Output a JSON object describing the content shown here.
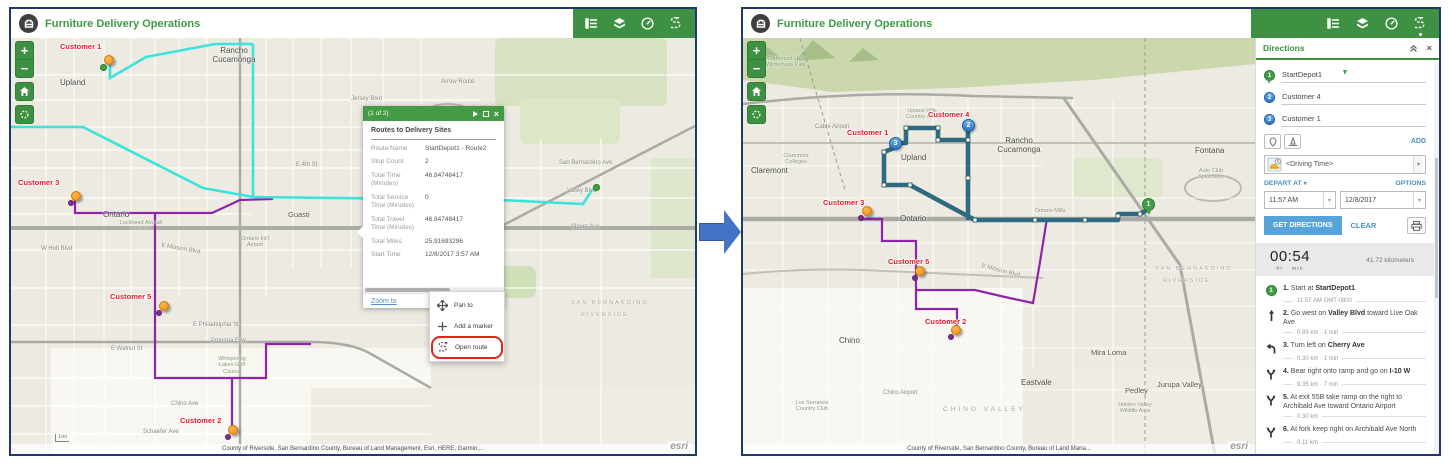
{
  "app": {
    "title": "Furniture Delivery Operations"
  },
  "colors": {
    "header_green": "#3E9142",
    "popup_green": "#459B45",
    "link_blue": "#4A90C4",
    "button_blue": "#58A3D9",
    "customer_red": "#E01726",
    "route_cyan": "#3BE3DB",
    "route_purple": "#8E24AA",
    "route_teal": "#2F6B80",
    "marker_orange": "#F5921E",
    "arrow_blue": "#4472C4"
  },
  "left": {
    "customers": [
      "Customer 1",
      "Customer 3",
      "Customer 5",
      "Customer 2"
    ],
    "popup": {
      "pager": "(1 of 2)",
      "title": "Routes to Delivery Sites",
      "fields": [
        {
          "label": "Route Name",
          "value": "StartDepot1 - Route2"
        },
        {
          "label": "Stop Count",
          "value": "2"
        },
        {
          "label": "Total Time (Minutes)",
          "value": "46.84748417"
        },
        {
          "label": "Total Service Time (Minutes)",
          "value": "0"
        },
        {
          "label": "Total Travel Time (Minutes)",
          "value": "46.84748417"
        },
        {
          "label": "Total Miles",
          "value": "25.91693296"
        },
        {
          "label": "Start Time",
          "value": "12/8/2017 3:57 AM"
        }
      ],
      "zoom_to": "Zoom to",
      "more": "..."
    },
    "menu": {
      "items": [
        {
          "label": "Pan to"
        },
        {
          "label": "Add a marker"
        },
        {
          "label": "Open route"
        }
      ]
    },
    "map_labels": [
      {
        "t": "Upland"
      },
      {
        "t": "Rancho Cucamonga"
      },
      {
        "t": "Ontario"
      },
      {
        "t": "Guasti"
      },
      {
        "t": "Arrow Route"
      },
      {
        "t": "Jersey Blvd"
      },
      {
        "t": "E 4th St"
      },
      {
        "t": "San Bernardino Ave"
      },
      {
        "t": "Valley Blvd"
      },
      {
        "t": "Slover Ave"
      },
      {
        "t": "E Mission Blvd"
      },
      {
        "t": "Ontario Int'l Airport"
      },
      {
        "t": "Lockheed Aircraft Services"
      },
      {
        "t": "Pomona Fwy"
      },
      {
        "t": "E Philadelphia St"
      },
      {
        "t": "E Walnut St"
      },
      {
        "t": "Chino Ave"
      },
      {
        "t": "Schaefer Ave"
      },
      {
        "t": "Whispering Lakes Golf Course"
      },
      {
        "t": "W Holt Blvd"
      },
      {
        "t": "SAN BERNARDINO"
      },
      {
        "t": "RIVERSIDE"
      },
      {
        "t": "1mi"
      },
      {
        "t": "Auto Club Speedway"
      }
    ],
    "attribution": "County of Riverside, San Bernardino County, Bureau of Land Management, Esri, HERE, Garmin,...",
    "esri": "esri"
  },
  "right": {
    "customers": [
      "Customer 1",
      "Customer 4",
      "Customer 3",
      "Customer 5",
      "Customer 2"
    ],
    "markers": {
      "p1": "1",
      "b2": "2",
      "b3": "3"
    },
    "map_labels": [
      {
        "t": "Claremont Hills Wilderness Park"
      },
      {
        "t": "Cable Airport"
      },
      {
        "t": "Claremont Colleges"
      },
      {
        "t": "Claremont"
      },
      {
        "t": "Upland Hills Country Club"
      },
      {
        "t": "Upland"
      },
      {
        "t": "Rancho Cucamonga"
      },
      {
        "t": "Fontana"
      },
      {
        "t": "Ontario"
      },
      {
        "t": "Ontario Mills"
      },
      {
        "t": "Auto Club Speedway"
      },
      {
        "t": "E Mission Blvd"
      },
      {
        "t": "Eastvale"
      },
      {
        "t": "Mira Loma"
      },
      {
        "t": "Pedley"
      },
      {
        "t": "Jurupa Valley"
      },
      {
        "t": "Chino"
      },
      {
        "t": "Chino Airport"
      },
      {
        "t": "CHINO VALLEY"
      },
      {
        "t": "SAN BERNARDINO"
      },
      {
        "t": "RIVERSIDE"
      },
      {
        "t": "Los Serranos Country Club"
      },
      {
        "t": "Hidden Valley Wildlife Area"
      }
    ],
    "panel": {
      "title": "Directions",
      "stops": [
        {
          "n": "1",
          "name": "StartDepot1"
        },
        {
          "n": "2",
          "name": "Customer 4"
        },
        {
          "n": "3",
          "name": "Customer 1"
        }
      ],
      "add": "ADD",
      "travel_mode": "<Driving Time>",
      "depart_at": "DEPART AT",
      "options": "OPTIONS",
      "time": "11:57 AM",
      "date": "12/8/2017",
      "get_directions": "GET DIRECTIONS",
      "clear": "CLEAR",
      "summary": {
        "duration": "00:54",
        "hr": "hr",
        "min": "min",
        "distance": "41.72 kilometers"
      },
      "steps": [
        {
          "n": "1.",
          "pre": "Start at ",
          "bold": "StartDepot1",
          "post": "",
          "sub": "11:57 AM GMT-0800"
        },
        {
          "n": "2.",
          "pre": "Go west on ",
          "bold": "Valley Blvd",
          "post": " toward Live Oak Ave",
          "sub": "0.99 km · 1 min"
        },
        {
          "n": "3.",
          "pre": "Turn left on ",
          "bold": "Cherry Ave",
          "post": "",
          "sub": "0.30 km · 1 min"
        },
        {
          "n": "4.",
          "pre": "Bear right onto ramp and go on ",
          "bold": "I-10 W",
          "post": "",
          "sub": "9.35 km · 7 min"
        },
        {
          "n": "5.",
          "pre": "At exit 55B take ramp on the right to Archibald Ave toward Ontario Airport",
          "bold": "",
          "post": "",
          "sub": "0.30 km"
        },
        {
          "n": "6.",
          "pre": "At fork keep right on Archibald Ave North",
          "bold": "",
          "post": "",
          "sub": "0.11 km"
        }
      ]
    },
    "attribution": "County of Riverside, San Bernardino County, Bureau of Land Mana...",
    "esri": "esri"
  }
}
